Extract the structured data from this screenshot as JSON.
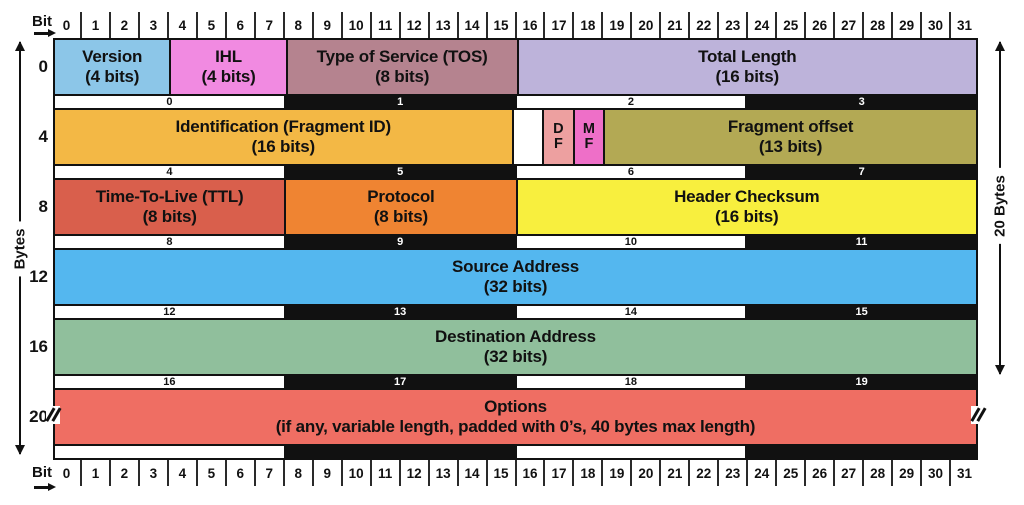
{
  "axes": {
    "bit_label_top": "Bit",
    "bit_label_bottom": "Bit",
    "bytes_label": "Bytes",
    "header_size_label": "20 Bytes",
    "bit_numbers": [
      "0",
      "1",
      "2",
      "3",
      "4",
      "5",
      "6",
      "7",
      "8",
      "9",
      "10",
      "11",
      "12",
      "13",
      "14",
      "15",
      "16",
      "17",
      "18",
      "19",
      "20",
      "21",
      "22",
      "23",
      "24",
      "25",
      "26",
      "27",
      "28",
      "29",
      "30",
      "31"
    ]
  },
  "bytes_axis": {
    "offsets": [
      "0",
      "4",
      "8",
      "12",
      "16",
      "20"
    ]
  },
  "table": {
    "rows": [
      {
        "kind": "fields",
        "name": "word-0",
        "cells": [
          {
            "id": "version",
            "bits": 4,
            "color": "#8cc6e8",
            "lines": [
              "Version",
              "(4 bits)"
            ]
          },
          {
            "id": "ihl",
            "bits": 4,
            "color": "#f18ae1",
            "lines": [
              "IHL",
              "(4 bits)"
            ]
          },
          {
            "id": "type-of-service",
            "bits": 8,
            "color": "#b5838f",
            "lines": [
              "Type of Service (TOS)",
              "(8 bits)"
            ]
          },
          {
            "id": "total-length",
            "bits": 16,
            "color": "#bdb3da",
            "lines": [
              "Total Length",
              "(16 bits)"
            ]
          }
        ]
      },
      {
        "kind": "strip",
        "name": "bytes-0-3",
        "cells": [
          {
            "text": "0",
            "theme": "light"
          },
          {
            "text": "1",
            "theme": "dark"
          },
          {
            "text": "2",
            "theme": "light"
          },
          {
            "text": "3",
            "theme": "dark"
          }
        ]
      },
      {
        "kind": "fields",
        "name": "word-1",
        "cells": [
          {
            "id": "identification",
            "bits": 16,
            "color": "#f3b845",
            "lines": [
              "Identification  (Fragment ID)",
              "(16 bits)"
            ]
          },
          {
            "id": "reserved-bit",
            "bits": 1,
            "color": "#ffffff",
            "lines": []
          },
          {
            "id": "df-flag",
            "bits": 1,
            "color": "#eda0a0",
            "lines": [
              "D",
              "F"
            ],
            "small": true
          },
          {
            "id": "mf-flag",
            "bits": 1,
            "color": "#ee6fc8",
            "lines": [
              "M",
              "F"
            ],
            "small": true
          },
          {
            "id": "fragment-offset",
            "bits": 13,
            "color": "#b3a954",
            "lines": [
              "Fragment offset",
              "(13 bits)"
            ]
          }
        ]
      },
      {
        "kind": "strip",
        "name": "bytes-4-7",
        "cells": [
          {
            "text": "4",
            "theme": "light"
          },
          {
            "text": "5",
            "theme": "dark"
          },
          {
            "text": "6",
            "theme": "light"
          },
          {
            "text": "7",
            "theme": "dark"
          }
        ]
      },
      {
        "kind": "fields",
        "name": "word-2",
        "cells": [
          {
            "id": "time-to-live",
            "bits": 8,
            "color": "#d95f4c",
            "lines": [
              "Time-To-Live (TTL)",
              "(8 bits)"
            ]
          },
          {
            "id": "protocol",
            "bits": 8,
            "color": "#ef8432",
            "lines": [
              "Protocol",
              "(8 bits)"
            ]
          },
          {
            "id": "header-checksum",
            "bits": 16,
            "color": "#f8ef3e",
            "lines": [
              "Header Checksum",
              "(16 bits)"
            ]
          }
        ]
      },
      {
        "kind": "strip",
        "name": "bytes-8-11",
        "cells": [
          {
            "text": "8",
            "theme": "light"
          },
          {
            "text": "9",
            "theme": "dark"
          },
          {
            "text": "10",
            "theme": "light"
          },
          {
            "text": "11",
            "theme": "dark"
          }
        ]
      },
      {
        "kind": "fields",
        "name": "word-3",
        "cells": [
          {
            "id": "source-address",
            "bits": 32,
            "color": "#54b7ef",
            "lines": [
              "Source Address",
              "(32 bits)"
            ]
          }
        ]
      },
      {
        "kind": "strip",
        "name": "bytes-12-15",
        "cells": [
          {
            "text": "12",
            "theme": "light"
          },
          {
            "text": "13",
            "theme": "dark"
          },
          {
            "text": "14",
            "theme": "light"
          },
          {
            "text": "15",
            "theme": "dark"
          }
        ]
      },
      {
        "kind": "fields",
        "name": "word-4",
        "cells": [
          {
            "id": "destination-address",
            "bits": 32,
            "color": "#90bf9c",
            "lines": [
              "Destination Address",
              "(32 bits)"
            ]
          }
        ]
      },
      {
        "kind": "strip",
        "name": "bytes-16-19",
        "cells": [
          {
            "text": "16",
            "theme": "light"
          },
          {
            "text": "17",
            "theme": "dark"
          },
          {
            "text": "18",
            "theme": "light"
          },
          {
            "text": "19",
            "theme": "dark"
          }
        ]
      },
      {
        "kind": "fields",
        "name": "word-5",
        "cells": [
          {
            "id": "options",
            "bits": 32,
            "color": "#ef6e63",
            "lines": [
              "Options",
              "(if any, variable length, padded with 0’s, 40 bytes max length)"
            ]
          }
        ]
      },
      {
        "kind": "strip",
        "name": "bytes-unlabeled",
        "cells": [
          {
            "text": "",
            "theme": "light"
          },
          {
            "text": "",
            "theme": "dark"
          },
          {
            "text": "",
            "theme": "light"
          },
          {
            "text": "",
            "theme": "dark"
          }
        ]
      }
    ]
  }
}
